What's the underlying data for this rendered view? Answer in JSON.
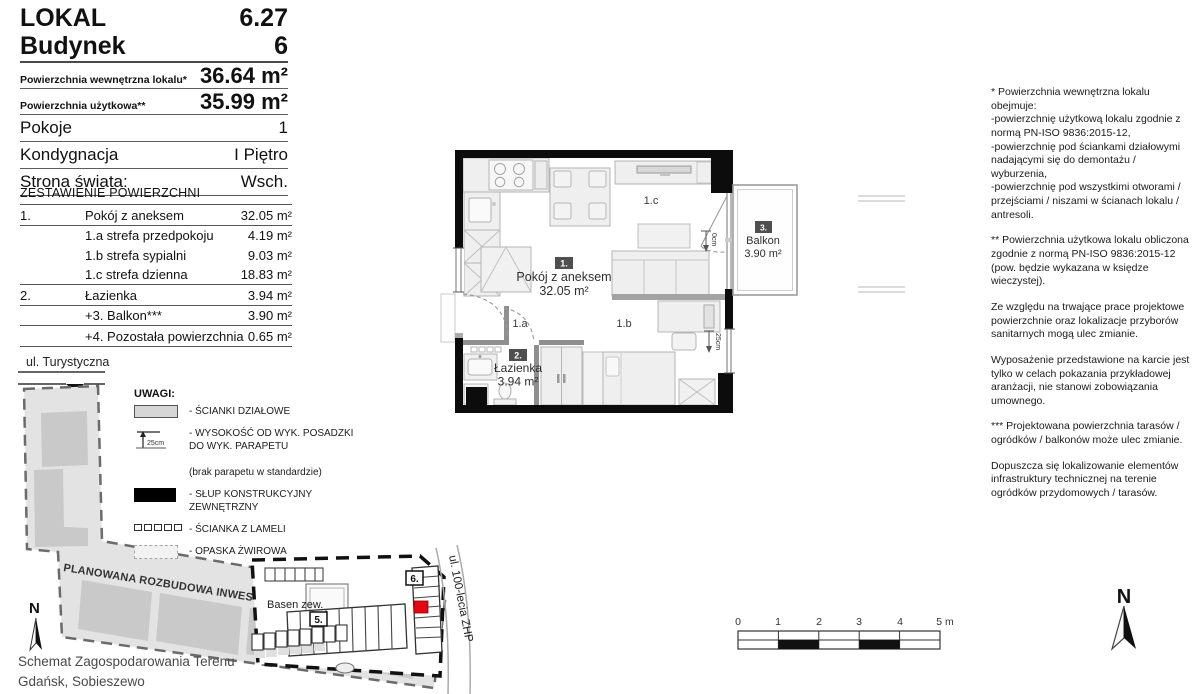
{
  "header": {
    "rows_big": [
      {
        "label": "LOKAL",
        "value": "6.27"
      },
      {
        "label": "Budynek",
        "value": "6"
      }
    ],
    "rows_area": [
      {
        "label": "Powierzchnia wewnętrzna lokalu*",
        "value": "36.64 m²"
      },
      {
        "label": "Powierzchnia użytkowa**",
        "value": "35.99 m²"
      }
    ],
    "rows_info": [
      {
        "label": "Pokoje",
        "value": "1"
      },
      {
        "label": "Kondygnacja",
        "value": "I Piętro"
      },
      {
        "label": "Strona świata:",
        "value": "Wsch."
      }
    ]
  },
  "area_table": {
    "title": "ZESTAWIENIE POWIERZCHNI",
    "rows": [
      {
        "no": "1.",
        "name": "Pokój z aneksem",
        "value": "32.05 m²"
      },
      {
        "no": "",
        "name": "1.a strefa przedpokoju",
        "value": "4.19 m²"
      },
      {
        "no": "",
        "name": "1.b strefa sypialni",
        "value": "9.03 m²"
      },
      {
        "no": "",
        "name": "1.c strefa dzienna",
        "value": "18.83 m²"
      },
      {
        "no": "2.",
        "name": "Łazienka",
        "value": "3.94 m²"
      },
      {
        "no": "",
        "name": "+3. Balkon***",
        "value": "3.90 m²"
      },
      {
        "no": "",
        "name": "+4. Pozostała powierzchnia",
        "value": "0.65 m²"
      }
    ]
  },
  "legend": {
    "title": "UWAGI:",
    "items": [
      {
        "icon": "partition-wall-swatch",
        "label": "- ŚCIANKI DZIAŁOWE"
      },
      {
        "icon": "sill-height-symbol",
        "symbol_text": "25cm",
        "label": "- WYSOKOŚĆ OD WYK. POSADZKI\nDO WYK. PARAPETU",
        "note": "(brak parapetu w standardzie)"
      },
      {
        "icon": "column-swatch",
        "label": "- SŁUP KONSTRUKCYJNY ZEWNĘTRZNY"
      },
      {
        "icon": "lamella-wall-swatch",
        "label": "- ŚCIANKA Z LAMELI"
      },
      {
        "icon": "gravel-strip-swatch",
        "label": "- OPASKA ŻWIROWA"
      }
    ]
  },
  "floor_plan": {
    "room1": {
      "badge": "1.",
      "name": "Pokój z aneksem",
      "area": "32.05 m²"
    },
    "zones": {
      "a": "1.a",
      "b": "1.b",
      "c": "1.c"
    },
    "room2": {
      "badge": "2.",
      "name": "Łazienka",
      "area": "3.94 m²"
    },
    "balcony": {
      "badge": "3.",
      "name": "Balkon",
      "area": "3.90 m²"
    },
    "annotations": {
      "balcony_door": "0cm",
      "window": "25cm"
    }
  },
  "site_plan": {
    "street_top": "ul. Turystyczna",
    "banner": "PLANOWANA ROZBUDOWA INWESTYCJI",
    "pool_label": "Basen zew.",
    "building5": "5.",
    "building6": "6.",
    "street_right": "ul. 100-lecia ZHP",
    "north": "N",
    "caption_line1": "Schemat Zagospodarowania Terenu",
    "caption_line2": "Gdańsk, Sobieszewo"
  },
  "scale_bar": {
    "t0": "0",
    "t1": "1",
    "t2": "2",
    "t3": "3",
    "t4": "4",
    "t5": "5 m"
  },
  "compass": {
    "label": "N"
  },
  "colors": {
    "highlight_red": "#e30613",
    "badge_gray": "#4f4f4f"
  },
  "notes": {
    "paragraphs": [
      "* Powierzchnia wewnętrzna lokalu obejmuje:\n -powierzchnię użytkową lokalu zgodnie z normą PN-ISO 9836:2015-12,\n -powierzchnię pod ściankami działowymi nadającymi się do demontażu / wyburzenia,\n -powierzchnię pod wszystkimi otworami / przejściami / niszami w ścianach lokalu / antresoli.",
      "** Powierzchnia użytkowa lokalu obliczona zgodnie z normą PN-ISO 9836:2015-12 (pow. będzie wykazana w księdze wieczystej).",
      "Ze względu na trwające prace projektowe powierzchnie oraz lokalizacje przyborów sanitarnych mogą ulec zmianie.",
      "Wyposażenie przedstawione na karcie jest tylko w celach pokazania przykładowej aranżacji, nie stanowi zobowiązania umownego.",
      "*** Projektowana powierzchnia tarasów / ogródków / balkonów może ulec zmianie.",
      "Dopuszcza się lokalizowanie elementów infrastruktury technicznej na terenie ogródków przydomowych / tarasów."
    ]
  }
}
